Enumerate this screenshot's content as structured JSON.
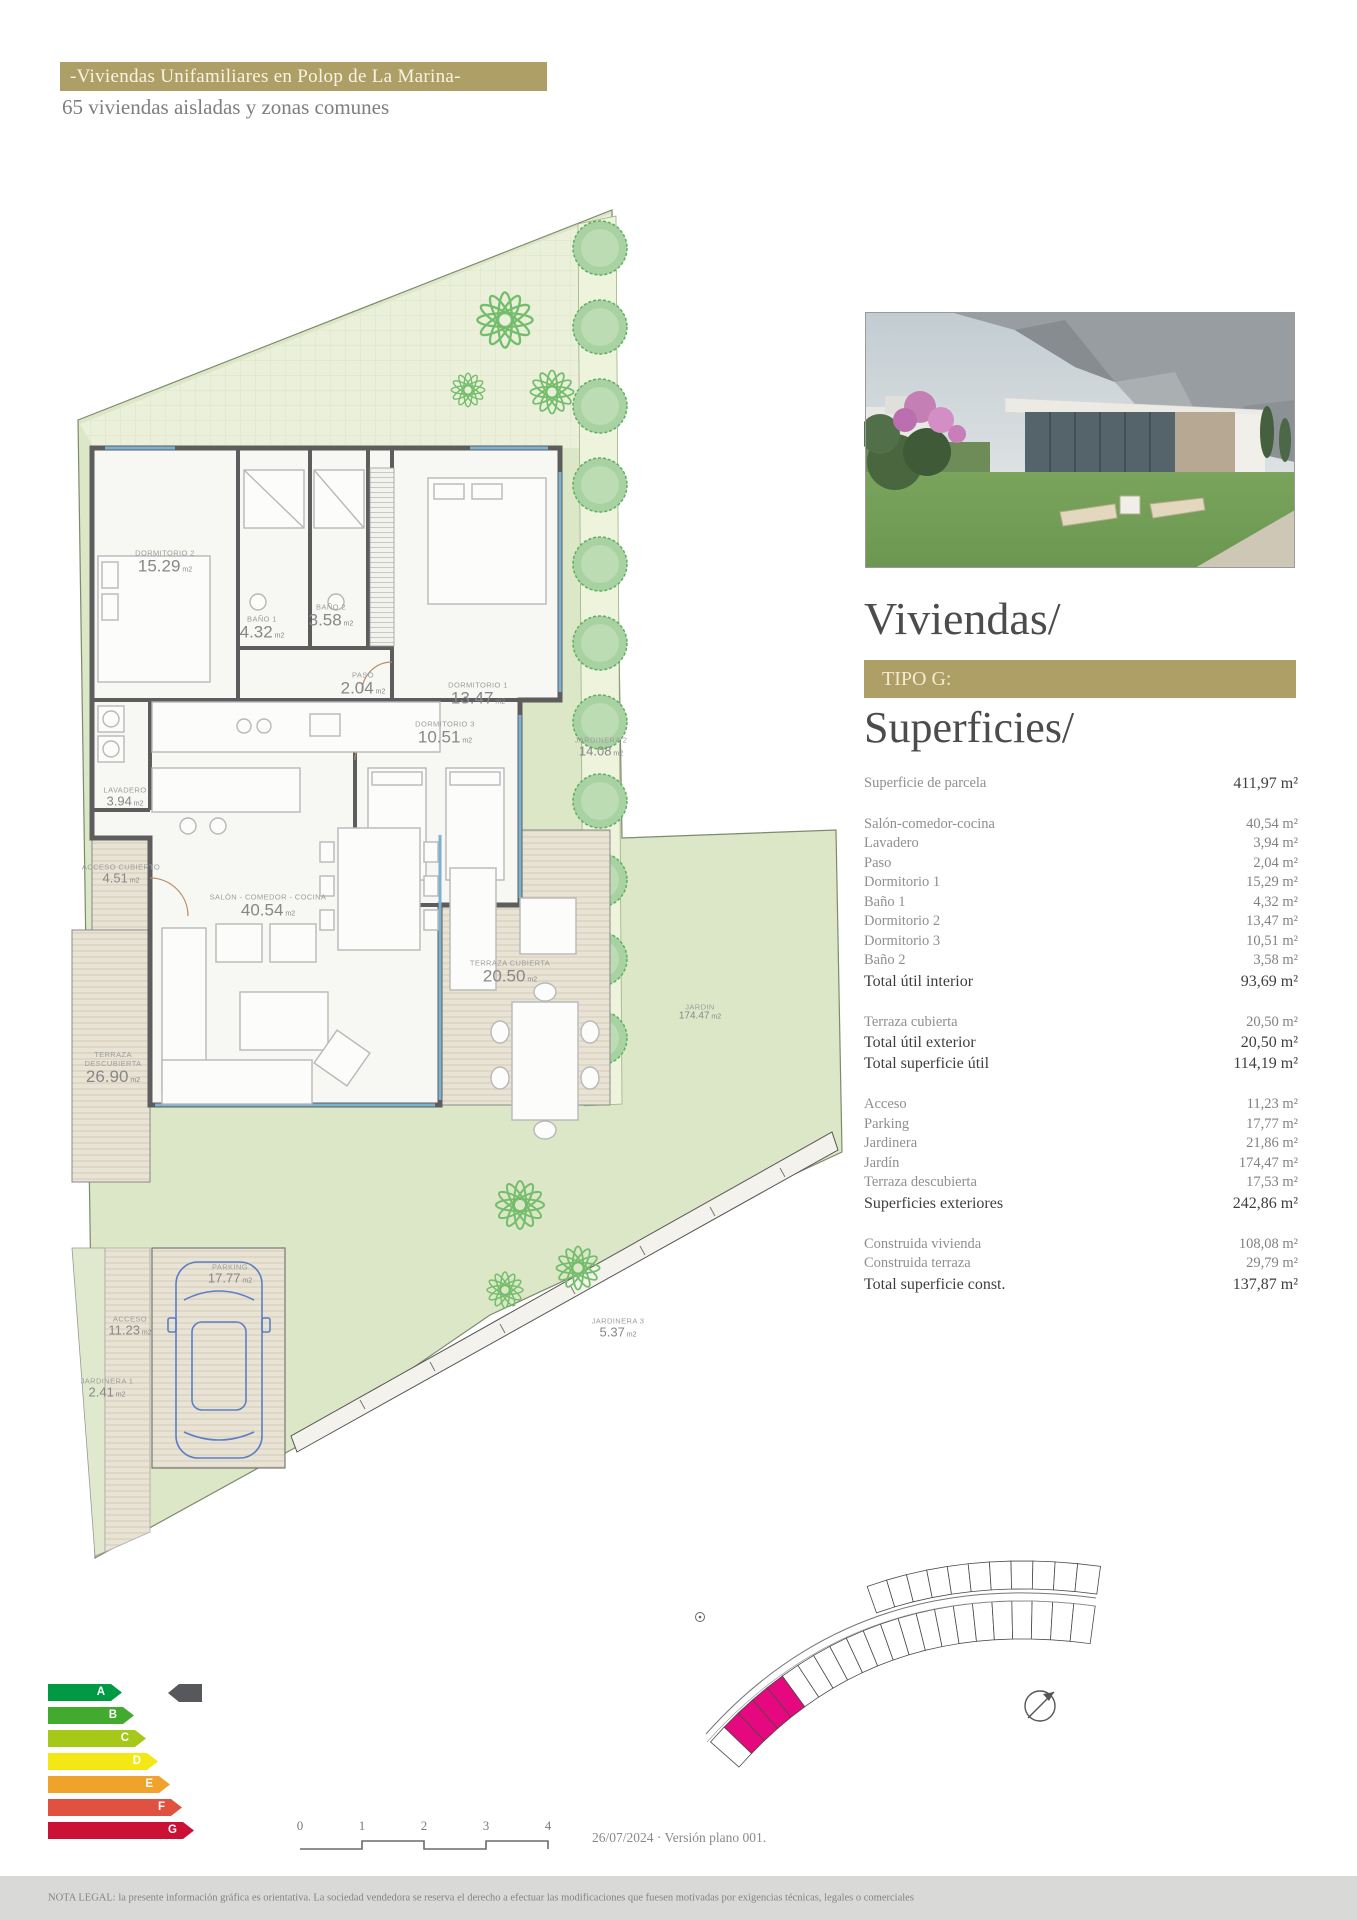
{
  "header": {
    "title": "-Viviendas Unifamiliares en Polop de La Marina-",
    "subtitle": "65 viviendas aisladas y zonas comunes"
  },
  "right_panel": {
    "section_title": "Viviendas/",
    "type_label": "TIPO G:",
    "subsection_title": "Superficies/",
    "table": {
      "groups": [
        {
          "rows": [
            {
              "label": "Superficie de parcela",
              "value": "411,97 m²",
              "strong": "value"
            }
          ]
        },
        {
          "rows": [
            {
              "label": "Salón-comedor-cocina",
              "value": "40,54 m²"
            },
            {
              "label": "Lavadero",
              "value": "3,94 m²"
            },
            {
              "label": "Paso",
              "value": "2,04 m²"
            },
            {
              "label": "Dormitorio 1",
              "value": "15,29 m²"
            },
            {
              "label": "Baño 1",
              "value": "4,32 m²"
            },
            {
              "label": "Dormitorio 2",
              "value": "13,47 m²"
            },
            {
              "label": "Dormitorio 3",
              "value": "10,51 m²"
            },
            {
              "label": "Baño 2",
              "value": "3,58 m²"
            },
            {
              "label": "Total útil interior",
              "value": "93,69 m²",
              "strong": "both"
            }
          ]
        },
        {
          "rows": [
            {
              "label": "Terraza cubierta",
              "value": "20,50 m²"
            },
            {
              "label": "Total útil exterior",
              "value": "20,50 m²",
              "strong": "both"
            },
            {
              "label": "Total superficie útil",
              "value": "114,19 m²",
              "strong": "both"
            }
          ]
        },
        {
          "rows": [
            {
              "label": "Acceso",
              "value": "11,23 m²"
            },
            {
              "label": "Parking",
              "value": "17,77 m²"
            },
            {
              "label": "Jardinera",
              "value": "21,86 m²"
            },
            {
              "label": "Jardín",
              "value": "174,47 m²"
            },
            {
              "label": "Terraza descubierta",
              "value": "17,53 m²"
            },
            {
              "label": "Superficies exteriores",
              "value": "242,86 m²",
              "strong": "both"
            }
          ]
        },
        {
          "rows": [
            {
              "label": "Construida vivienda",
              "value": "108,08 m²"
            },
            {
              "label": "Construida terraza",
              "value": "29,79 m²"
            },
            {
              "label": "Total superficie const.",
              "value": "137,87 m²",
              "strong": "both"
            }
          ]
        }
      ]
    }
  },
  "floor_plan": {
    "rooms": {
      "dormitorio2": {
        "name": "DORMITORIO 2",
        "area": "15.29",
        "unit": "m2"
      },
      "bano1": {
        "name": "BAÑO 1",
        "area": "4.32",
        "unit": "m2"
      },
      "bano2": {
        "name": "BAÑO 2",
        "area": "3.58",
        "unit": "m2"
      },
      "paso": {
        "name": "PASO",
        "area": "2.04",
        "unit": "m2"
      },
      "dormitorio1": {
        "name": "DORMITORIO 1",
        "area": "13.47",
        "unit": "m2"
      },
      "dormitorio3": {
        "name": "DORMITORIO 3",
        "area": "10.51",
        "unit": "m2"
      },
      "lavadero": {
        "name": "LAVADERO",
        "area": "3.94",
        "unit": "m2"
      },
      "acceso_cubierto": {
        "name": "ACCESO CUBIERTO",
        "area": "4.51",
        "unit": "m2"
      },
      "salon": {
        "name": "SALÓN - COMEDOR - COCINA",
        "area": "40.54",
        "unit": "m2"
      },
      "terraza_cubierta": {
        "name": "TERRAZA CUBIERTA",
        "area": "20.50",
        "unit": "m2"
      },
      "terraza_descubierta": {
        "name": "TERRAZA DESCUBIERTA",
        "area": "26.90",
        "unit": "m2"
      },
      "jardin": {
        "name": "JARDIN",
        "area": "174.47",
        "unit": "m2"
      },
      "jardinera2": {
        "name": "JARDINERA 2",
        "area": "14.08",
        "unit": "m2"
      },
      "jardinera3": {
        "name": "JARDINERA 3",
        "area": "5.37",
        "unit": "m2"
      },
      "parking": {
        "name": "PARKING",
        "area": "17.77",
        "unit": "m2"
      },
      "acceso": {
        "name": "ACCESO",
        "area": "11.23",
        "unit": "m2"
      },
      "jardinera1": {
        "name": "JARDINERA 1",
        "area": "2.41",
        "unit": "m2"
      }
    }
  },
  "energy_chart": {
    "ratings": [
      {
        "letter": "A",
        "color": "#009a44"
      },
      {
        "letter": "B",
        "color": "#42ab2f"
      },
      {
        "letter": "C",
        "color": "#a6c818"
      },
      {
        "letter": "D",
        "color": "#f3e816"
      },
      {
        "letter": "E",
        "color": "#efa32a"
      },
      {
        "letter": "F",
        "color": "#e0523f"
      },
      {
        "letter": "G",
        "color": "#cb1236"
      }
    ],
    "selected_arrow_color": "#57585c"
  },
  "site_plan": {
    "highlight_color": "#e5087e"
  },
  "footer": {
    "scale_ticks": [
      "0",
      "1",
      "2",
      "3",
      "4"
    ],
    "version": "26/07/2024 · Versión plano 001.",
    "legal": "NOTA LEGAL: la presente información gráfica es orientativa. La sociedad vendedora se reserva el derecho a efectuar las modificaciones que fuesen motivadas por exigencias técnicas, legales o comerciales"
  }
}
